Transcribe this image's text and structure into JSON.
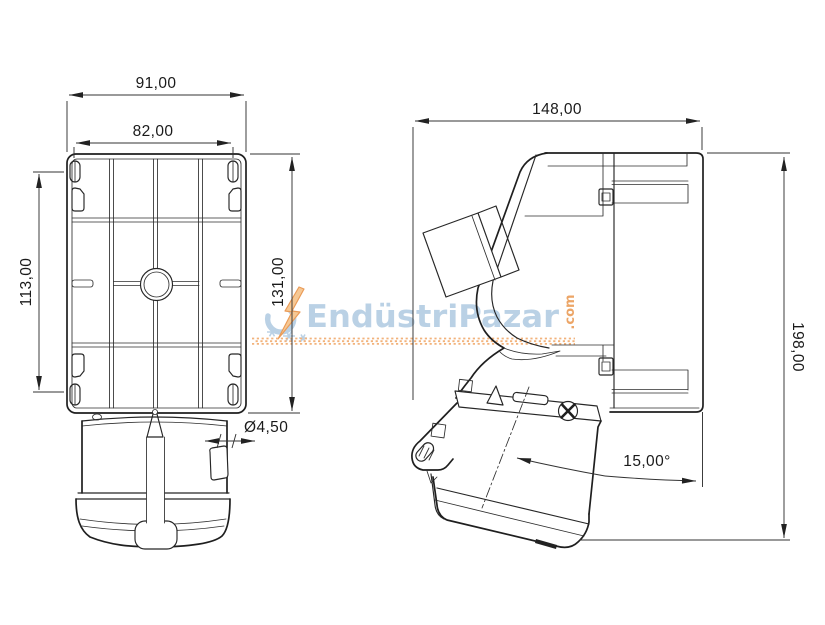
{
  "drawing": {
    "type": "technical-dimension-drawing",
    "subject": "Industrial wall-mounted CEE socket, front and side views",
    "line_color": "#222222",
    "background": "#ffffff"
  },
  "front_view": {
    "dim_width_outer": "91,00",
    "dim_width_inner": "82,00",
    "dim_height_left": "113,00",
    "dim_height_right": "131,00",
    "dim_hole_diameter": "Ø4,50"
  },
  "side_view": {
    "dim_depth": "148,00",
    "dim_height": "198,00",
    "dim_angle": "15,00°"
  },
  "watermark": {
    "brand": "EndüstriPazar",
    "tld": ".com",
    "text_color": "#b7cfe4",
    "accent_color": "#eba15f",
    "bolt_fill": "#f6c68f",
    "dots_color": "#f2ae74"
  }
}
